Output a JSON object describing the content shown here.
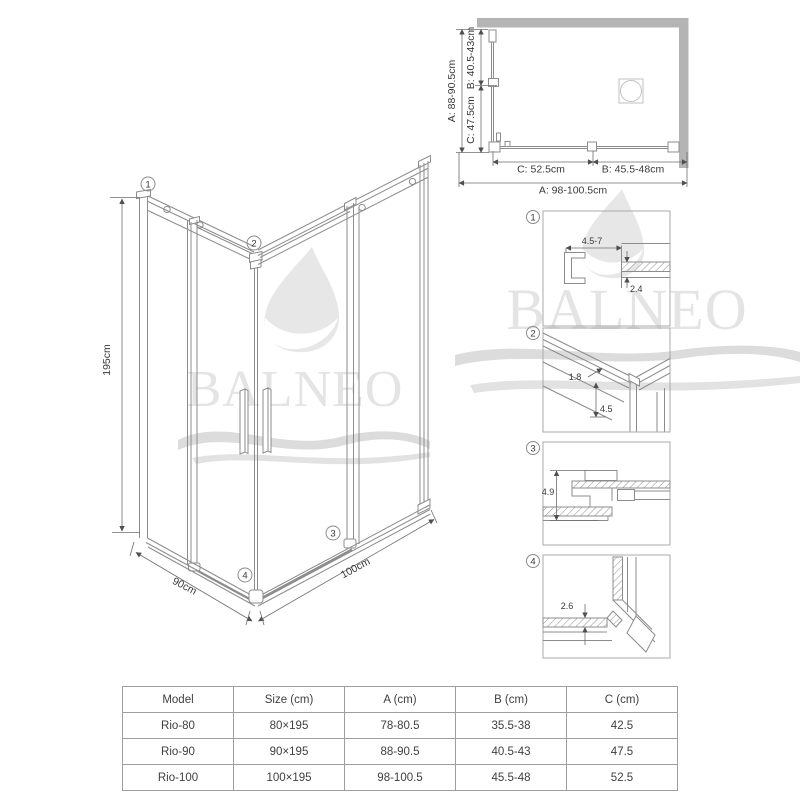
{
  "brand": {
    "name": "BALNEO"
  },
  "plan_view": {
    "labels": {
      "a_left": "A: 88-90.5cm",
      "b_left": "B: 40.5-43cm",
      "c_left": "C: 47.5cm",
      "c_bottom": "C: 52.5cm",
      "b_bottom": "B: 45.5-48cm",
      "a_bottom": "A: 98-100.5cm"
    }
  },
  "iso_view": {
    "labels": {
      "height": "195cm",
      "depth": "90cm",
      "width": "100cm"
    },
    "markers": {
      "m1": "1",
      "m2": "2",
      "m3": "3",
      "m4": "4"
    }
  },
  "details": {
    "d1": {
      "num": "1",
      "dim_width": "4.5-7",
      "dim_thickness": "2.4"
    },
    "d2": {
      "num": "2",
      "dim_offset": "1.8",
      "dim_height": "4.5"
    },
    "d3": {
      "num": "3",
      "dim_height": "4.9"
    },
    "d4": {
      "num": "4",
      "dim_gap": "2.6"
    }
  },
  "spec_table": {
    "headers": [
      "Model",
      "Size (cm)",
      "A (cm)",
      "B (cm)",
      "C (cm)"
    ],
    "rows": [
      [
        "Rio-80",
        "80×195",
        "78-80.5",
        "35.5-38",
        "42.5"
      ],
      [
        "Rio-90",
        "90×195",
        "88-90.5",
        "40.5-43",
        "47.5"
      ],
      [
        "Rio-100",
        "100×195",
        "98-100.5",
        "45.5-48",
        "52.5"
      ]
    ]
  },
  "colors": {
    "wall": "#b4b4b4",
    "line": "#8c8c8c",
    "dim_text": "#3a3a3a",
    "watermark": "#e4e4e4",
    "table_border": "#9e9e9e"
  }
}
